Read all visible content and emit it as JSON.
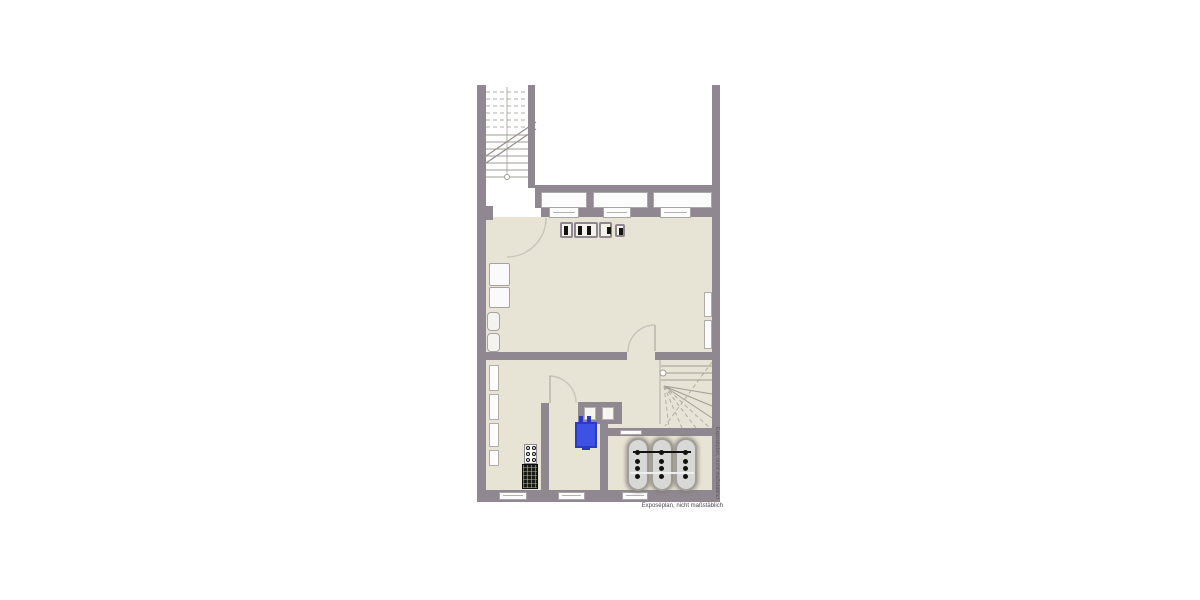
{
  "plan": {
    "disclaimer": "Exposéplan, nicht maßstäblich",
    "side_watermark": "Exposéplan, nicht maßstäblich",
    "colors": {
      "background": "#ffffff",
      "wall": "#8f8890",
      "floor": "#e7e4d5",
      "boiler_blue": "#3d52e4",
      "tank_fill": "#d8d8d6",
      "line_gray": "#a29c96"
    },
    "objects": {
      "straight_staircase": 1,
      "winder_staircase": 1,
      "oil_tanks": 3,
      "top_windows": 3,
      "bottom_windows": 3,
      "lightwells": 3,
      "door_swings": 3,
      "blue_boiler": 1,
      "chimney_flues": 2,
      "meter_boxes": 4
    }
  }
}
